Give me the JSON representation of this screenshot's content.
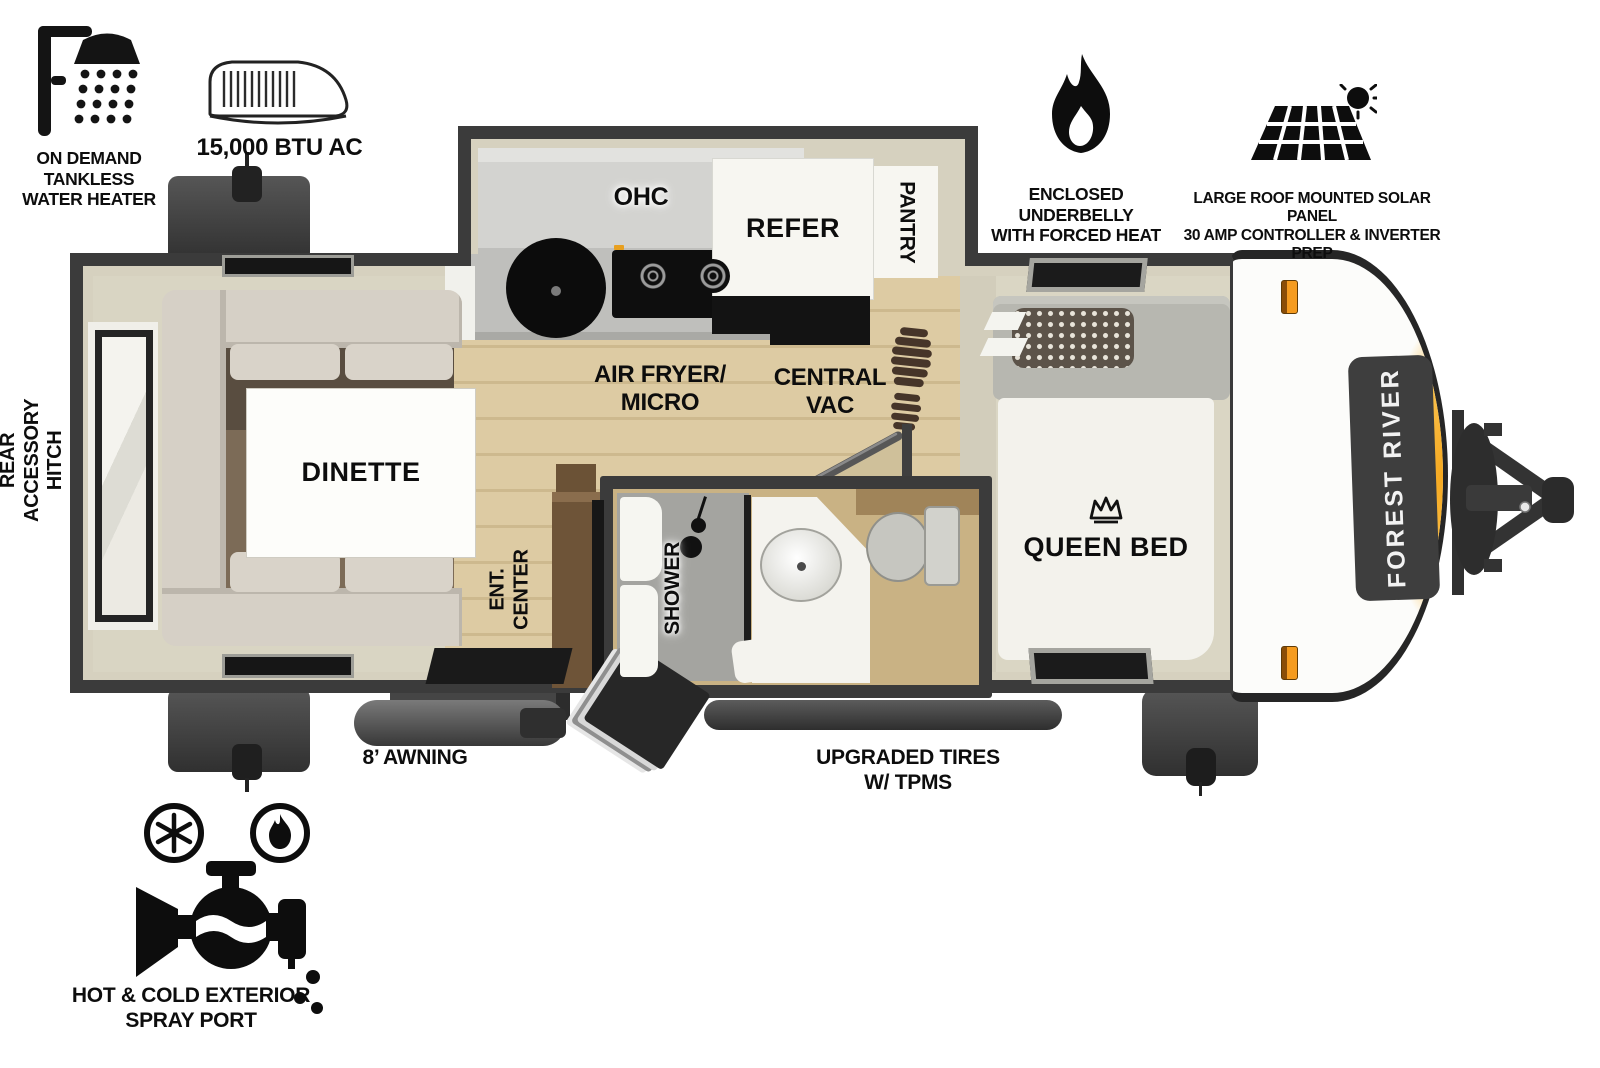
{
  "title": "Travel trailer floor plan",
  "features": {
    "water_heater": {
      "lines": [
        "ON DEMAND",
        "TANKLESS",
        "WATER HEATER"
      ]
    },
    "ac": {
      "label": "15,000 BTU AC"
    },
    "underbelly": {
      "lines": [
        "ENCLOSED UNDERBELLY",
        "WITH FORCED HEAT"
      ]
    },
    "solar": {
      "lines": [
        "LARGE ROOF MOUNTED SOLAR PANEL",
        "30 AMP CONTROLLER & INVERTER PREP"
      ]
    },
    "rear_hitch": {
      "lines": [
        "REAR",
        "ACCESSORY",
        "HITCH"
      ]
    },
    "spray_port": {
      "lines": [
        "HOT & COLD EXTERIOR",
        "SPRAY PORT"
      ]
    },
    "awning": {
      "label": "8’ AWNING"
    },
    "tires": {
      "lines": [
        "UPGRADED TIRES",
        "W/ TPMS"
      ]
    }
  },
  "interior": {
    "ohc": "OHC",
    "refer": "REFER",
    "pantry": "PANTRY",
    "air_fryer": [
      "AIR FRYER/",
      "MICRO"
    ],
    "central_vac": [
      "CENTRAL",
      "VAC"
    ],
    "dinette": "DINETTE",
    "ent_center": [
      "ENT.",
      "CENTER"
    ],
    "shower": "SHOWER",
    "queen_bed": "QUEEN BED"
  },
  "exterior": {
    "brand": "FOREST RIVER"
  },
  "colors": {
    "wall": "#3b3b3b",
    "wall_liner": "#d6d1bf",
    "wood_floor": "#dcc9a0",
    "bath_floor": "#c9b284",
    "accent_orange": "#f49b1f",
    "cap_swoosh": "#f6a81e"
  }
}
